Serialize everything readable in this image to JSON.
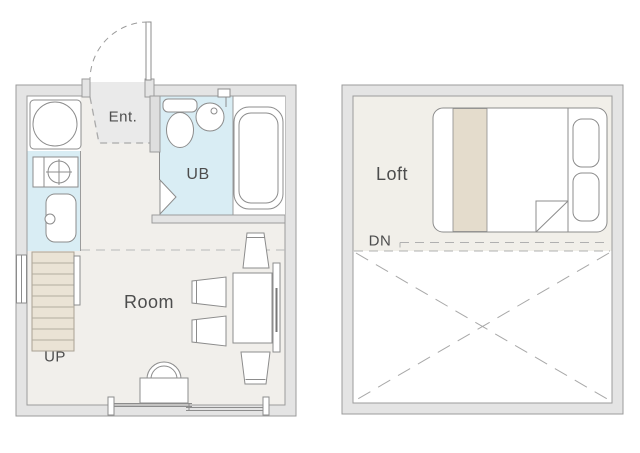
{
  "floorplan": {
    "title": "studio-apartment-floorplan",
    "labels": {
      "ent": "Ent.",
      "ub": "UB",
      "room": "Room",
      "up": "UP",
      "loft": "Loft",
      "dn": "DN"
    },
    "floor1": {
      "rooms": [
        {
          "id": "entrance",
          "label": "Ent."
        },
        {
          "id": "unit-bath",
          "label": "UB"
        },
        {
          "id": "main-room",
          "label": "Room"
        },
        {
          "id": "stairs-up",
          "label": "UP"
        }
      ],
      "fixtures": [
        "entrance-door",
        "washing-machine",
        "stove-burner",
        "kitchen-sink",
        "toilet",
        "wash-basin",
        "bathtub",
        "folding-door",
        "staircase",
        "side-window",
        "dining-table",
        "wall-board",
        "chair",
        "chair",
        "chair",
        "chair",
        "stool",
        "desk",
        "sliding-window",
        "loft-overhang-dashed-line"
      ]
    },
    "floor2": {
      "rooms": [
        {
          "id": "loft",
          "label": "Loft"
        },
        {
          "id": "stairs-down",
          "label": "DN"
        }
      ],
      "fixtures": [
        "double-bed",
        "bed-runner",
        "pillow",
        "pillow",
        "sheet-fold",
        "loft-edge-dashed-line",
        "open-void-x"
      ]
    },
    "colors": {
      "background": "#ffffff",
      "wall_fill": "#e4e4e4",
      "wall_line": "#9b9b9b",
      "floor_room": "#f1efeb",
      "floor_loft": "#f1efe9",
      "floor_entrance": "#eaeaea",
      "wet_area_blue": "#d9edf4",
      "stairs_fill": "#eae3d5",
      "stairs_line": "#b3ac9e",
      "bed_accent_tan": "#e4dccc",
      "fixture_line": "#8c8c8c",
      "dash_line": "#aaaaaa",
      "text": "#4d4d4d"
    }
  }
}
